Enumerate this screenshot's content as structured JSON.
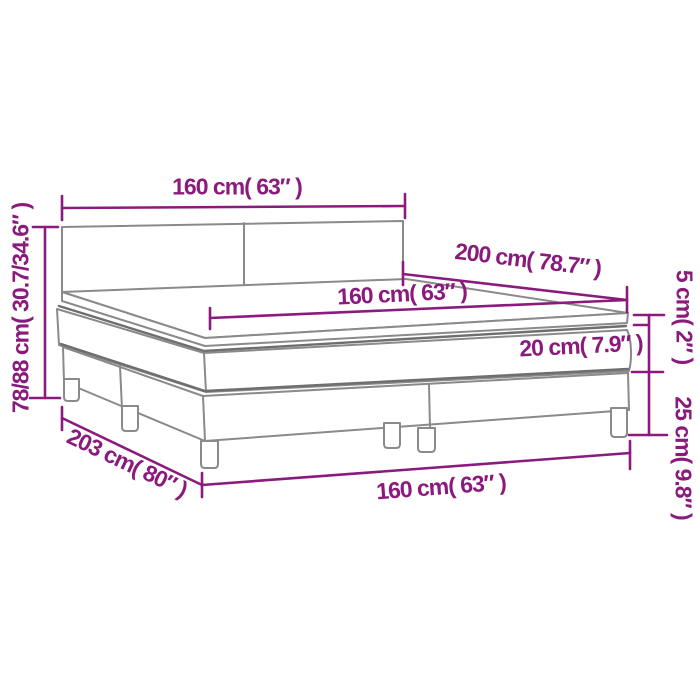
{
  "page": {
    "background": "#FFFFFF"
  },
  "colors": {
    "dimension_color": "#8B1A7D",
    "bed_outline_color": "#8A8A8A",
    "seam_color": "#6E6E6E"
  },
  "diagram": {
    "subject": "Box spring bed with mattress and topper — dimension diagram",
    "labels": {
      "headboard_width": "160 cm( 63″ )",
      "bed_length": "200 cm( 78.7″ )",
      "mattress_width": "160 cm( 63″ )",
      "mattress_height": "20 cm( 7.9″ )",
      "topper_height": "5 cm( 2″ )",
      "base_height": "25 cm( 9.8″ )",
      "total_height": "78/88 cm( 30.7/34.6″ )",
      "total_length": "203 cm( 80″ )",
      "base_width": "160 cm( 63″ )"
    }
  }
}
